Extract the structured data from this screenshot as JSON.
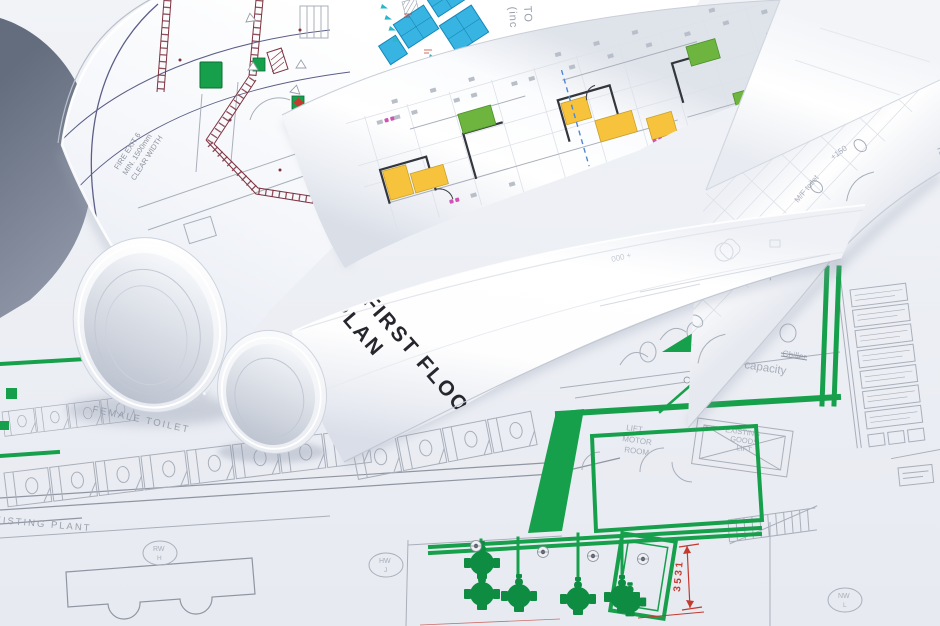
{
  "colors": {
    "paper": "#fdfdfe",
    "table_shadow": "#6e7686",
    "plan_line": "#a9afba",
    "green": "#17a04c",
    "green_dark": "#0e8c41",
    "maroon": "#7d3340",
    "navy": "#5c5e88",
    "cyan_room": "#38b4e3",
    "yellow_room": "#f7c33c",
    "green_room": "#6db53e",
    "magenta": "#d052b4",
    "blue_dash": "#4f86d4",
    "red": "#c23b2e",
    "teal": "#2ab6c9",
    "ink": "#26262e",
    "text_gray": "#8d939e"
  },
  "roll_title": {
    "line1": "FIRST FLOOR",
    "line2": "PLAN"
  },
  "sheet_notes": {
    "fire_exit_1": "FIRE EXIT 6",
    "fire_exit_2": "MIN. 1500mm",
    "fire_exit_3": "CLEAR WIDTH",
    "top_note_1": "TO",
    "top_note_2": "(inc"
  },
  "plan_labels": {
    "female_toilet": "FEMALE TOILET",
    "existing_plant": "EXISTING PLANT",
    "lift_motor_room_1": "LIFT",
    "lift_motor_room_2": "MOTOR",
    "lift_motor_room_3": "ROOM",
    "goods_lift_1": "EXISTING",
    "goods_lift_2": "GOODS",
    "goods_lift_3": "LIFT",
    "chiller": "Chiller",
    "capacity": "capacity",
    "dim": "3531",
    "marker_rw_1": "RW",
    "marker_rw_2": "H",
    "marker_hw_1": "HW",
    "marker_hw_2": "J",
    "marker_nw_1": "NW",
    "marker_nw_2": "L"
  },
  "roll_grid_labels": {
    "capacity": "capacity",
    "kavus": "KAVUS",
    "plus150": "+150",
    "mf_toilet": "M/F toilet",
    "faint": "000 +"
  }
}
